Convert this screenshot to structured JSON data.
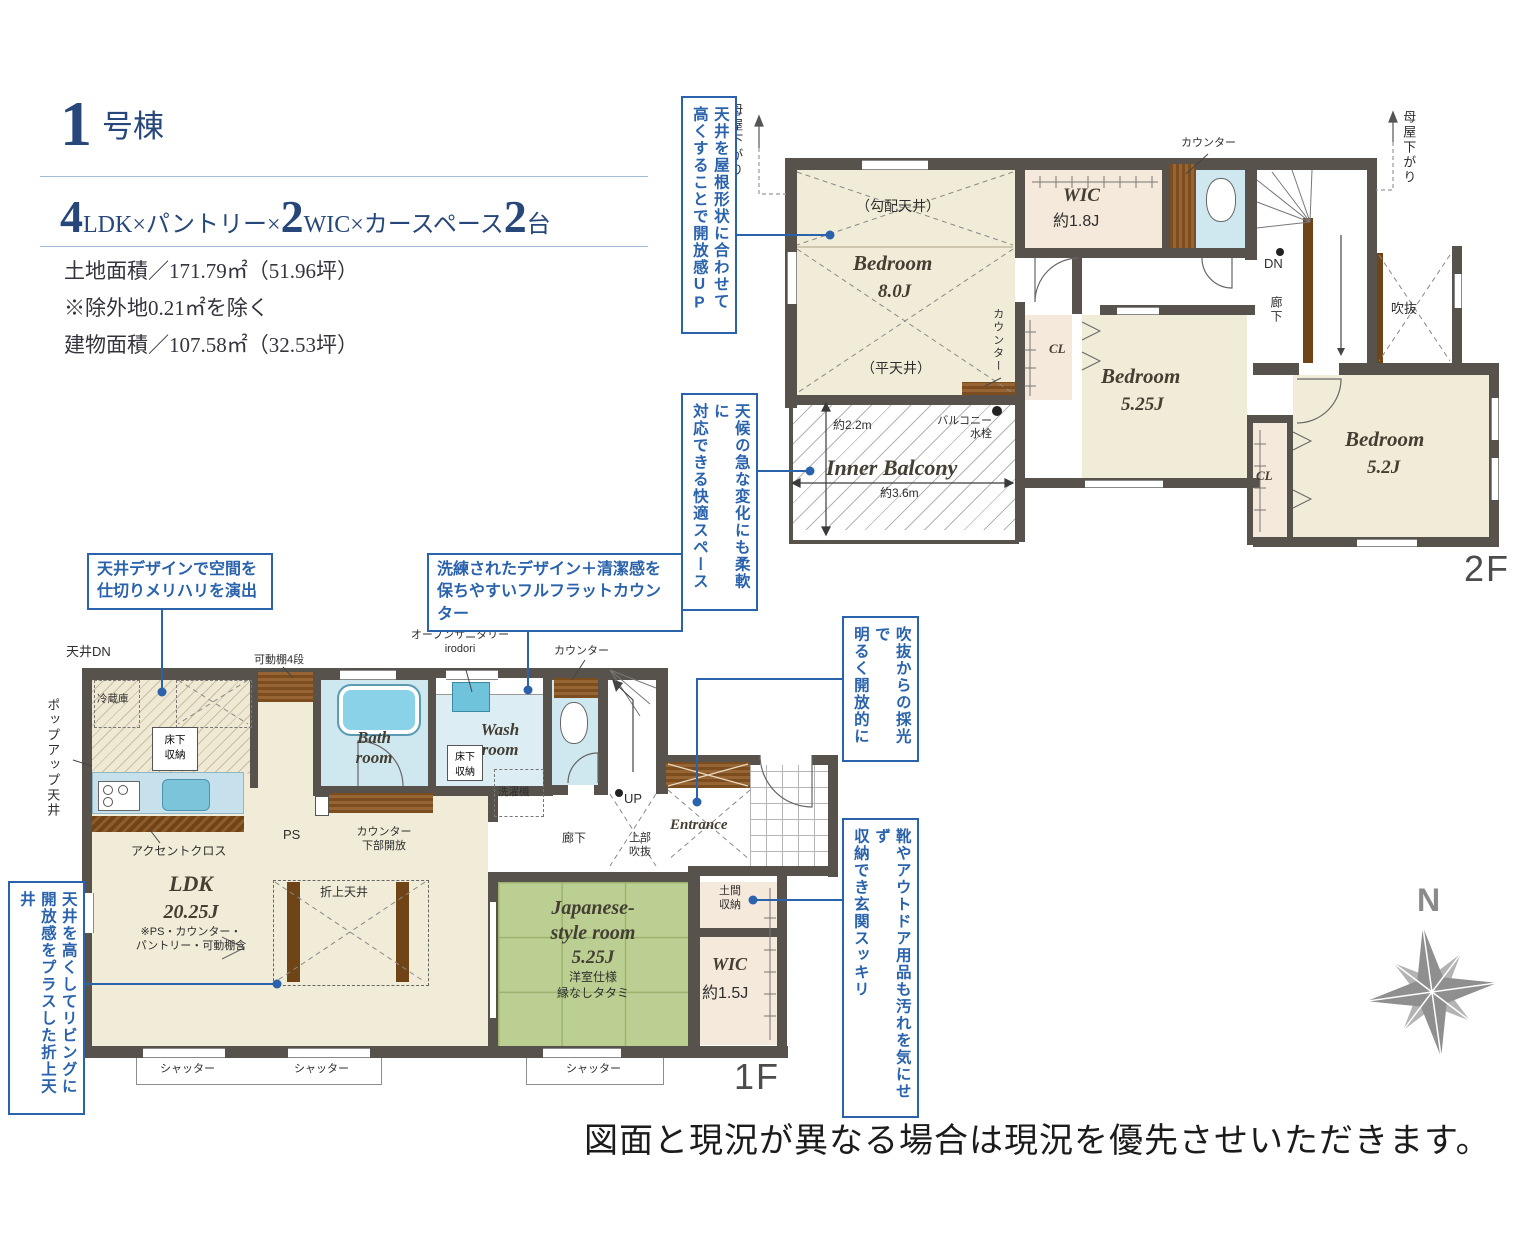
{
  "colors": {
    "accent_blue": "#2a62ac",
    "wall": "#57534c",
    "room_beige": "#f1ecd7",
    "room_pink": "#f5e9db",
    "room_blue": "#cfe7ee",
    "tatami_green": "#bccf93",
    "wood_brown": "#7c4e1f",
    "title_navy": "#27477a"
  },
  "title": {
    "num": "1",
    "name": "号棟",
    "spec": [
      {
        "n": "4",
        "t": "LDK×パントリー×"
      },
      {
        "n": "2",
        "t": "WIC×カースペース"
      },
      {
        "n": "2",
        "t": "台"
      }
    ],
    "land": "土地面積／171.79㎡（51.96坪）",
    "exclude": "※除外地0.21㎡を除く",
    "building": "建物面積／107.58㎡（32.53坪）"
  },
  "callouts": {
    "c1a": "天井を屋根形状に合わせて",
    "c1b": "高くすることで開放感UP",
    "c2a": "天候の急な変化にも柔軟に",
    "c2b": "対応できる快適スペース",
    "c3a": "天井デザインで空間を",
    "c3b": "仕切りメリハリを演出",
    "c4a": "洗練されたデザイン＋清潔感を",
    "c4b": "保ちやすいフルフラットカウンター",
    "c5a": "吹抜からの採光で",
    "c5b": "明るく開放的に",
    "c6a": "靴やアウトドア用品も汚れを気にせず",
    "c6b": "収納でき玄関スッキリ",
    "c7a": "天井を高くしてリビングに",
    "c7b": "開放感をプラスした折上天井"
  },
  "f2": {
    "floor": "2F",
    "moya": "母屋下がり",
    "counter": "カウンター",
    "slope": "（勾配天井）",
    "flat": "（平天井）",
    "bed8": "Bedroom",
    "bed8_size": "8.0J",
    "wic": "WIC",
    "wic_size": "約1.8J",
    "dn": "DN",
    "hall": "廊下",
    "void": "吹抜",
    "cl": "CL",
    "bed525": "Bedroom",
    "bed525_size": "5.25J",
    "bed52": "Bedroom",
    "bed52_size": "5.2J",
    "balcony": "Inner Balcony",
    "dim_v": "約2.2m",
    "dim_h": "約3.6m",
    "faucet1": "バルコニー",
    "faucet2": "水栓"
  },
  "f1": {
    "floor": "1F",
    "ceiling_dn": "天井DN",
    "popup": "ポップアップ天井",
    "fridge": "冷蔵庫",
    "underfloor1": "床下",
    "underfloor2": "収納",
    "accent": "アクセントクロス",
    "shelf": "可動棚4段",
    "sanitary1": "オープンサニタリー",
    "sanitary2": "irodori",
    "counter": "カウンター",
    "bath1": "Bath",
    "bath2": "room",
    "wash1": "Wash",
    "wash2": "room",
    "washer": "洗濯機",
    "ps": "PS",
    "counter_open1": "カウンター",
    "counter_open2": "下部開放",
    "up": "UP",
    "hall": "廊下",
    "void1": "上部",
    "void2": "吹抜",
    "entrance": "Entrance",
    "doma1": "土間",
    "doma2": "収納",
    "wic": "WIC",
    "wic_size": "約1.5J",
    "jp1": "Japanese-",
    "jp2": "style room",
    "jp3": "5.25J",
    "jp4": "洋室仕様",
    "jp5": "縁なしタタミ",
    "ldk": "LDK",
    "ldk_size": "20.25J",
    "ldk_note1": "※PS・カウンター・",
    "ldk_note2": "パントリー・可動棚含",
    "oriage": "折上天井",
    "shutter": "シャッター"
  },
  "disclaimer": "図面と現況が異なる場合は現況を優先させいただきます。",
  "compass_n": "N"
}
